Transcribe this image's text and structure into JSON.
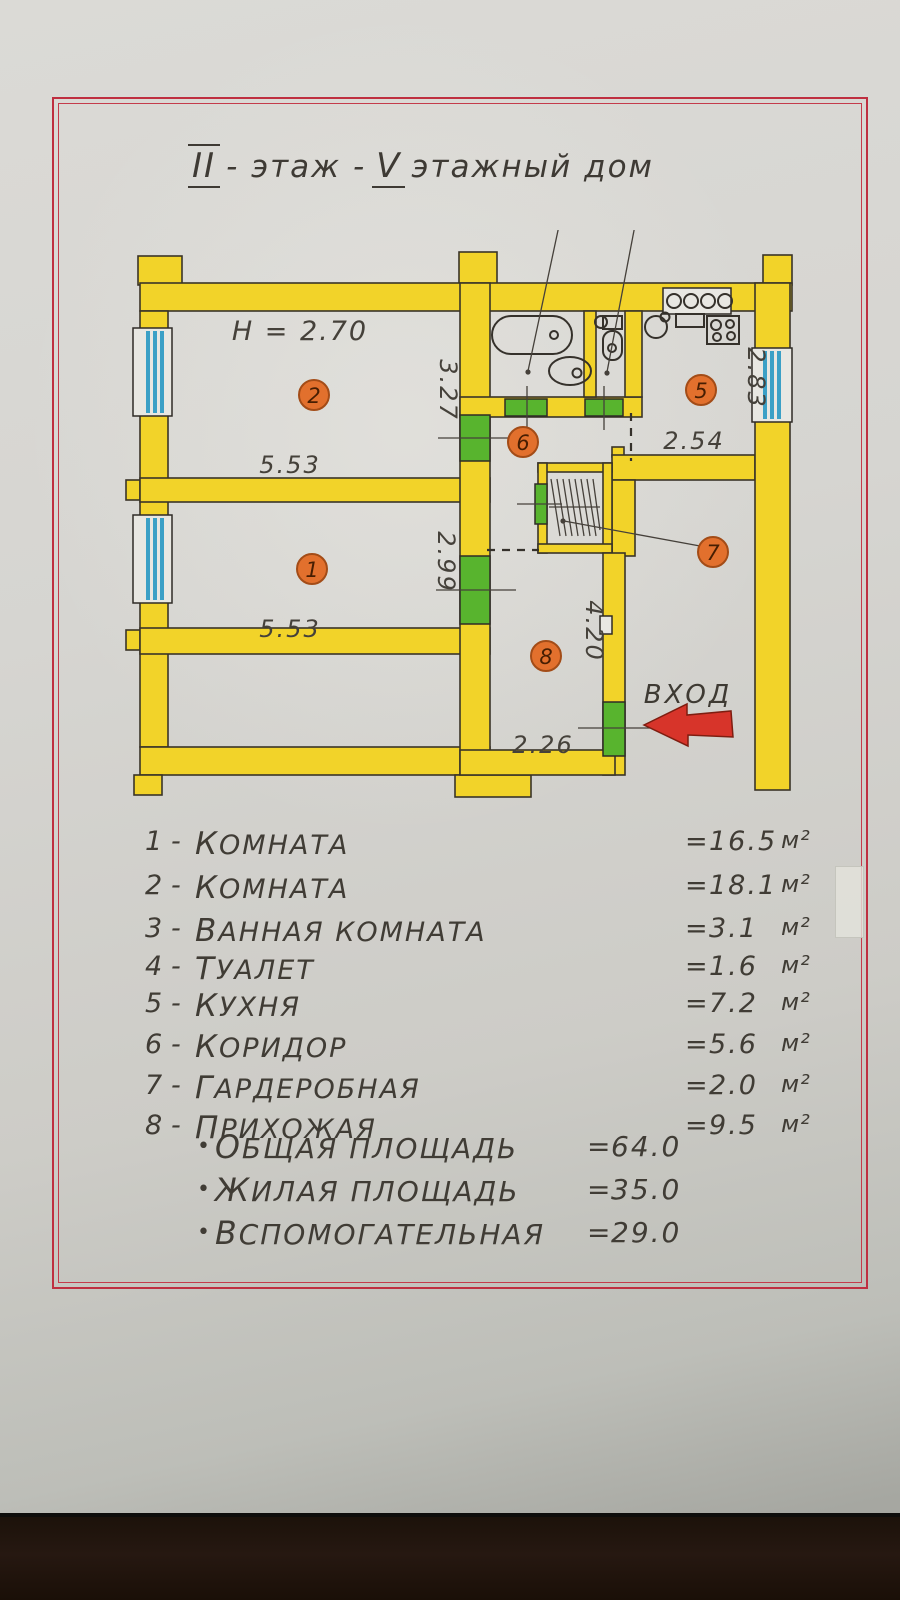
{
  "title": {
    "numeral_floor": "II",
    "text_floor": "- этаж -",
    "numeral_building": "V",
    "text_building": "этажный дом"
  },
  "plan": {
    "ceiling_height": "H = 2.70",
    "entrance_label": "Вход",
    "markers": [
      "1",
      "2",
      "3",
      "4",
      "5",
      "6",
      "7",
      "8"
    ],
    "dims": {
      "room2_width": "5.53",
      "room2_depth": "3.27",
      "room1_width": "5.53",
      "room1_depth": "2.99",
      "kitchen_depth": "2.83",
      "kitchen_width": "2.54",
      "hall_depth": "4.20",
      "hall_width": "2.26"
    }
  },
  "legend": {
    "items": [
      {
        "num": "1",
        "dash": "-",
        "name": "Комната",
        "eq": "=",
        "area": "16.5",
        "unit": "м²"
      },
      {
        "num": "2",
        "dash": "-",
        "name": "Комната",
        "eq": "=",
        "area": "18.1",
        "unit": "м²"
      },
      {
        "num": "3",
        "dash": "-",
        "name": "Ванная комната",
        "eq": "=",
        "area": "3.1",
        "unit": "м²"
      },
      {
        "num": "4",
        "dash": "-",
        "name": "Туалет",
        "eq": "=",
        "area": "1.6",
        "unit": "м²"
      },
      {
        "num": "5",
        "dash": "-",
        "name": "Кухня",
        "eq": "=",
        "area": "7.2",
        "unit": "м²"
      },
      {
        "num": "6",
        "dash": "-",
        "name": "Коридор",
        "eq": "=",
        "area": "5.6",
        "unit": "м²"
      },
      {
        "num": "7",
        "dash": "-",
        "name": "Гардеробная",
        "eq": "=",
        "area": "2.0",
        "unit": "м²"
      },
      {
        "num": "8",
        "dash": "-",
        "name": "Прихожая",
        "eq": "=",
        "area": "9.5",
        "unit": "м²"
      }
    ],
    "totals": [
      {
        "bullet": "•",
        "name": "Общая площадь",
        "eq": "=",
        "value": "64.0"
      },
      {
        "bullet": "•",
        "name": "Жилая площадь",
        "eq": "=",
        "value": "35.0"
      },
      {
        "bullet": "•",
        "name": "Вспомогательная",
        "eq": "=",
        "value": "29.0"
      }
    ]
  },
  "colors": {
    "wall_yellow": "#f2d329",
    "door_green": "#58b42e",
    "window_blue": "#3ba0c6",
    "marker_orange": "#e2702d",
    "frame_red": "#bf2f40",
    "arrow_red": "#d7342a",
    "ink": "#45413a"
  }
}
